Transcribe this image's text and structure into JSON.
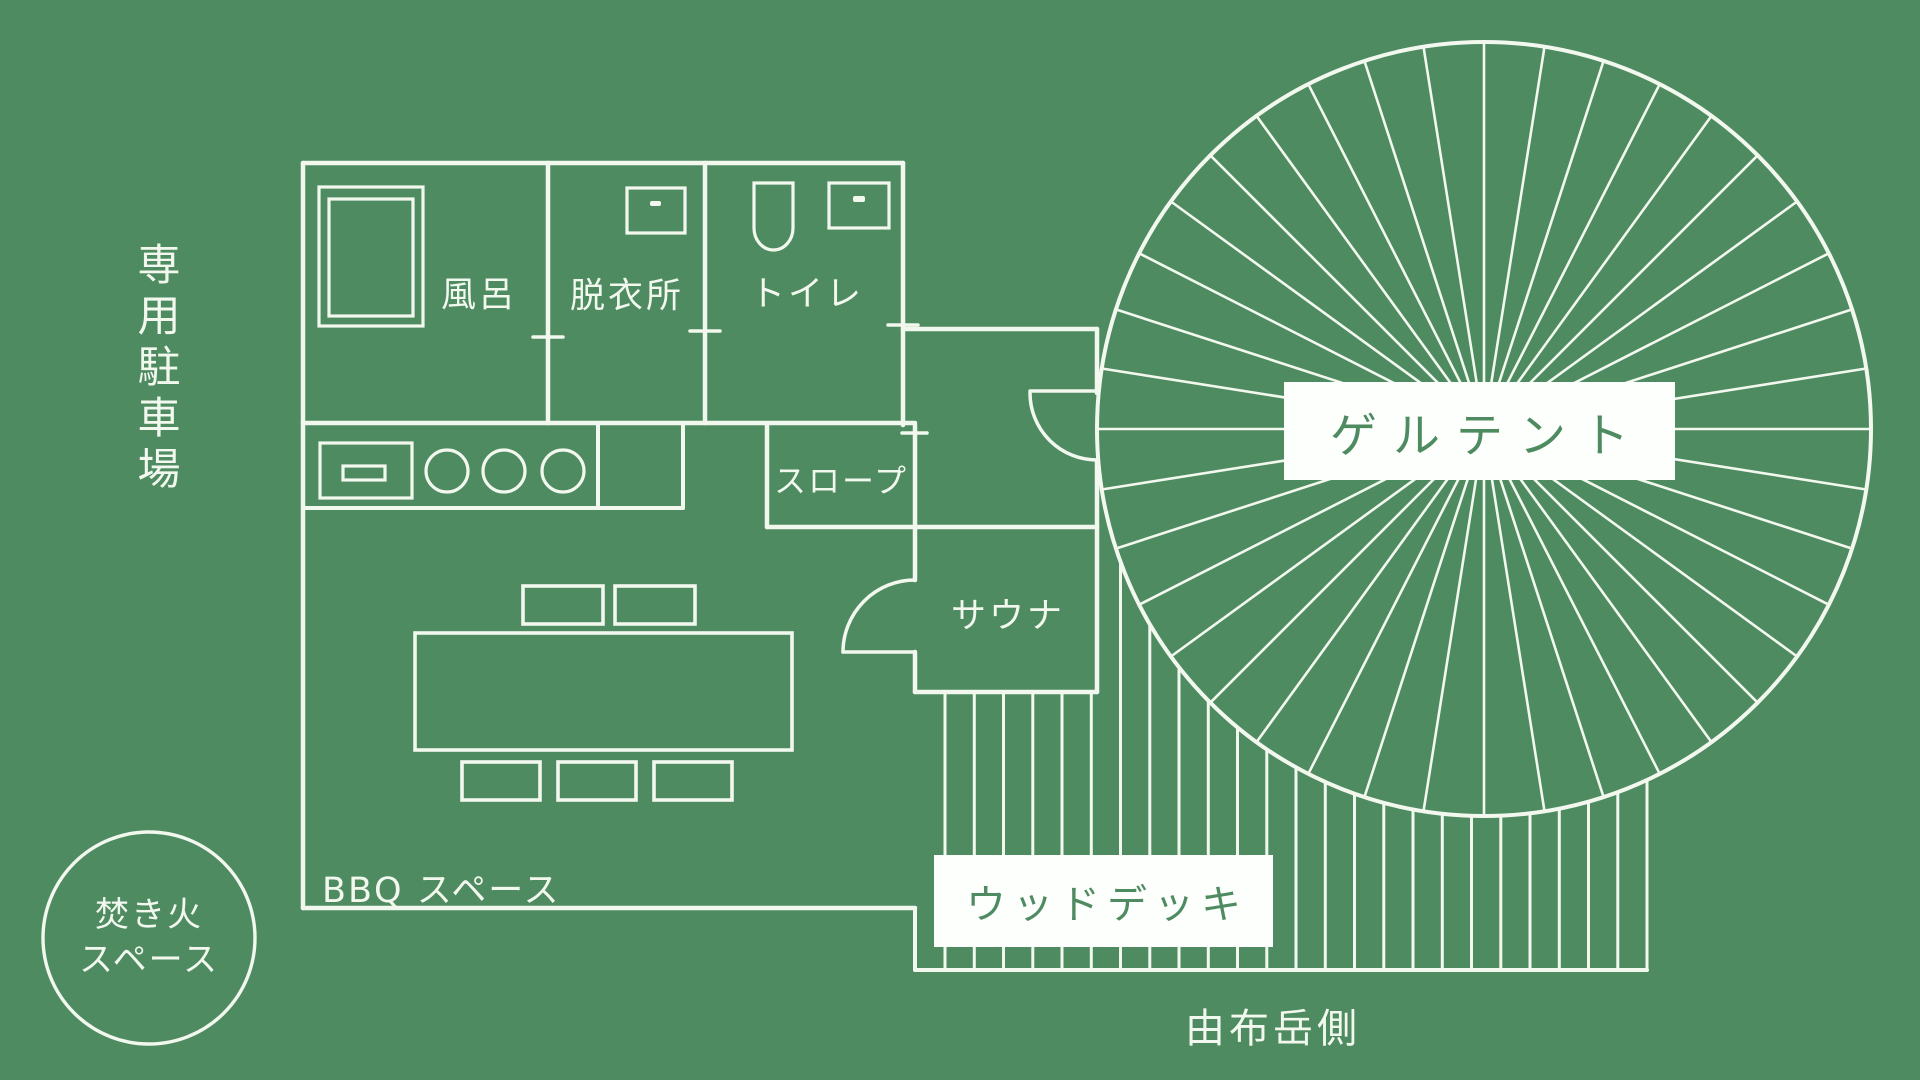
{
  "title": "グランピング施設 場内マップ（floor plan）",
  "colors": {
    "background": "#4e8b61",
    "line": "#f2f8ee",
    "label_box_bg": "#fdfffc",
    "label_text_green": "#4e8b61"
  },
  "labels": {
    "parking": "専用駐車場",
    "bath": "風呂",
    "changing_room": "脱衣所",
    "toilet": "トイレ",
    "slope": "スロープ",
    "sauna": "サウナ",
    "ger_tent": "ゲルテント",
    "wood_deck": "ウッドデッキ",
    "bbq_space": "BBQ スペース",
    "bonfire_space_line1": "焚き火",
    "bonfire_space_line2": "スペース",
    "mt_yufu_side": "由布岳側"
  }
}
